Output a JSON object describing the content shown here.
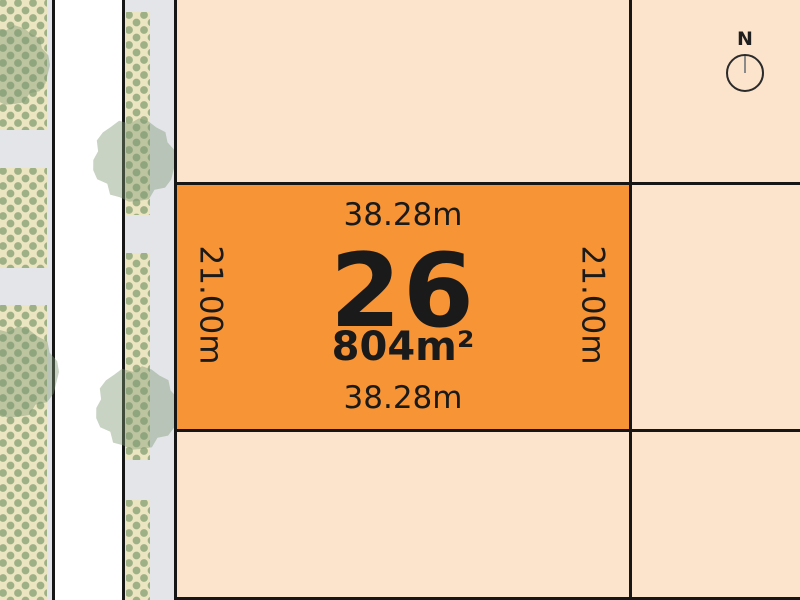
{
  "lot": {
    "number": "26",
    "area": "804m²",
    "dim_top": "38.28m",
    "dim_bottom": "38.28m",
    "dim_left": "21.00m",
    "dim_right": "21.00m"
  },
  "compass": {
    "north_label": "N"
  },
  "colors": {
    "lot_fill": "#F69436",
    "background": "#FCE3CB",
    "road": "#FFFFFF",
    "verge": "#E3E5E8",
    "planting_bed": "#ECE5C2",
    "planting_dot": "#9EB086",
    "tree": "rgba(125,150,115,0.42)",
    "line": "#161616",
    "text": "#1A1A1A"
  }
}
